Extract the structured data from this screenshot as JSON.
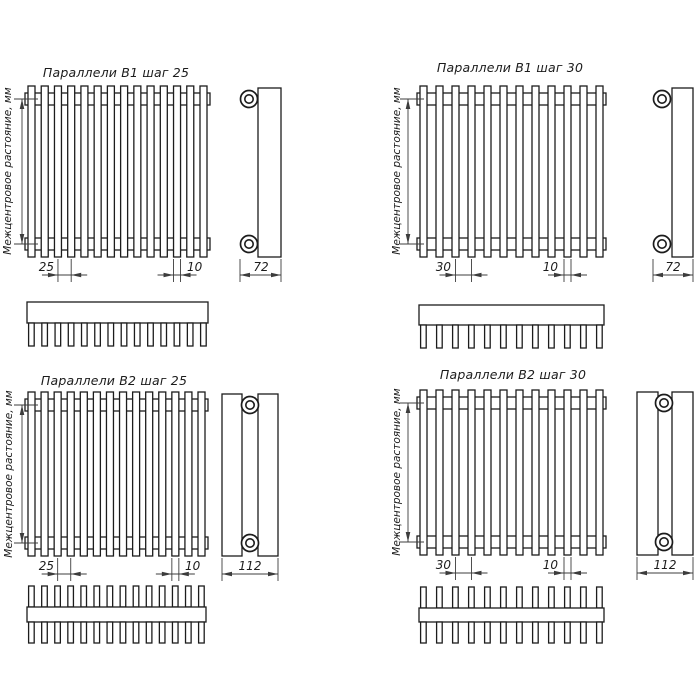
{
  "drawing": {
    "axis_label": "Межцентровое растояние, мм",
    "diagrams": [
      {
        "title": "Параллели В1 шаг 25",
        "step": "25",
        "tube_width": "10",
        "depth": "72",
        "tubes": 14,
        "rows": 1
      },
      {
        "title": "Параллели В1 шаг 30",
        "step": "30",
        "tube_width": "10",
        "depth": "72",
        "tubes": 12,
        "rows": 1
      },
      {
        "title": "Параллели В2 шаг 25",
        "step": "25",
        "tube_width": "10",
        "depth": "112",
        "tubes": 14,
        "rows": 2
      },
      {
        "title": "Параллели В2 шаг 30",
        "step": "30",
        "tube_width": "10",
        "depth": "112",
        "tubes": 12,
        "rows": 2
      }
    ],
    "colors": {
      "line": "#1c1c1c",
      "dim_line": "#3c3c3c",
      "background": "#ffffff"
    }
  }
}
